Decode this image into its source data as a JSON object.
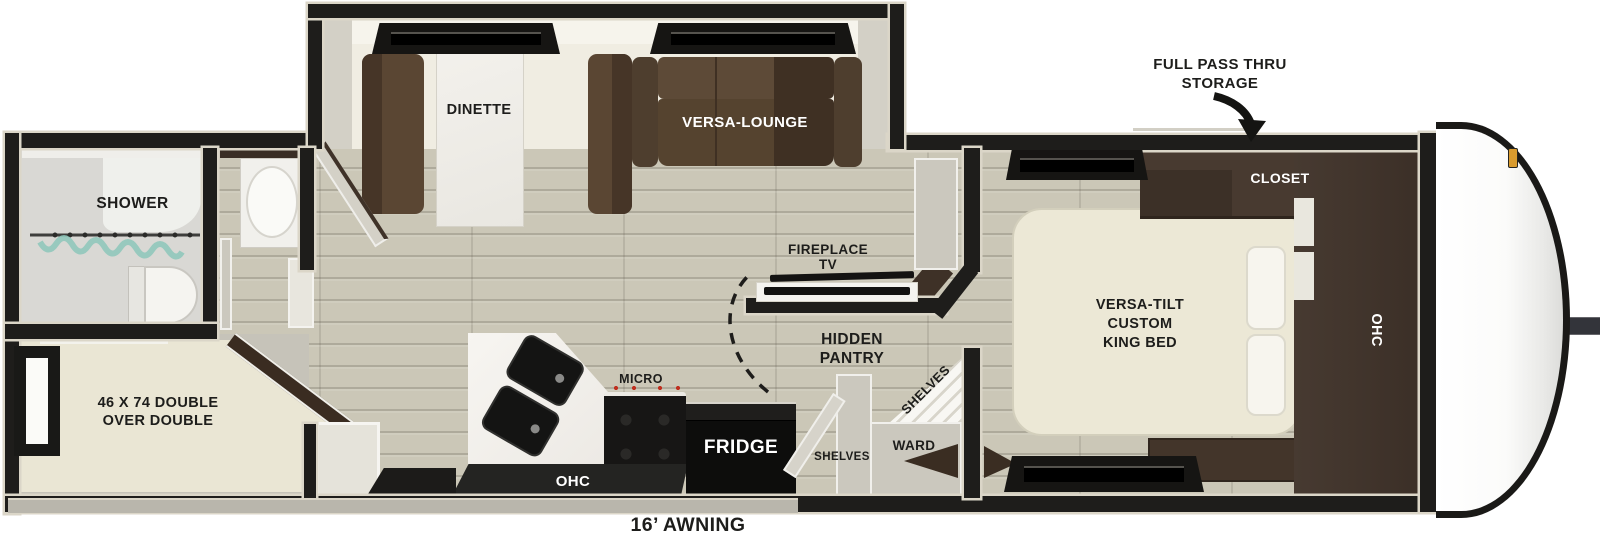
{
  "plan": {
    "type": "rv-travel-trailer-floorplan",
    "labels": {
      "full_pass_thru_1": "FULL PASS THRU",
      "full_pass_thru_2": "STORAGE",
      "dinette": "DINETTE",
      "versa_lounge": "VERSA-LOUNGE",
      "shower": "SHOWER",
      "closet": "CLOSET",
      "king_bed_1": "VERSA-TILT",
      "king_bed_2": "CUSTOM",
      "king_bed_3": "KING BED",
      "ohc_bedroom": "OHC",
      "fireplace_1": "FIREPLACE",
      "fireplace_2": "TV",
      "hidden_pantry_1": "HIDDEN",
      "hidden_pantry_2": "PANTRY",
      "shelves_corner": "SHELVES",
      "shelves_wall": "SHELVES",
      "ward": "WARD",
      "micro": "MICRO",
      "fridge": "FRIDGE",
      "ohc_kitchen": "OHC",
      "bunk_1": "46 X 74 DOUBLE",
      "bunk_2": "OVER DOUBLE",
      "awning": "16’ AWNING"
    },
    "colors": {
      "walls": "#1e1d1b",
      "floor_wood": "#cbc7b7",
      "slide_floor": "#f0ede2",
      "upholstery_brown": "#5a4633",
      "cabinet_wood": "#43352a",
      "bedding_cream": "#eae6d4",
      "appliance_black": "#121110",
      "curtain_teal": "#8cc7ba",
      "marker_amber": "#d99b2e",
      "trim_beige": "#d9d4c6",
      "burner_red": "#bf2f1f"
    }
  }
}
